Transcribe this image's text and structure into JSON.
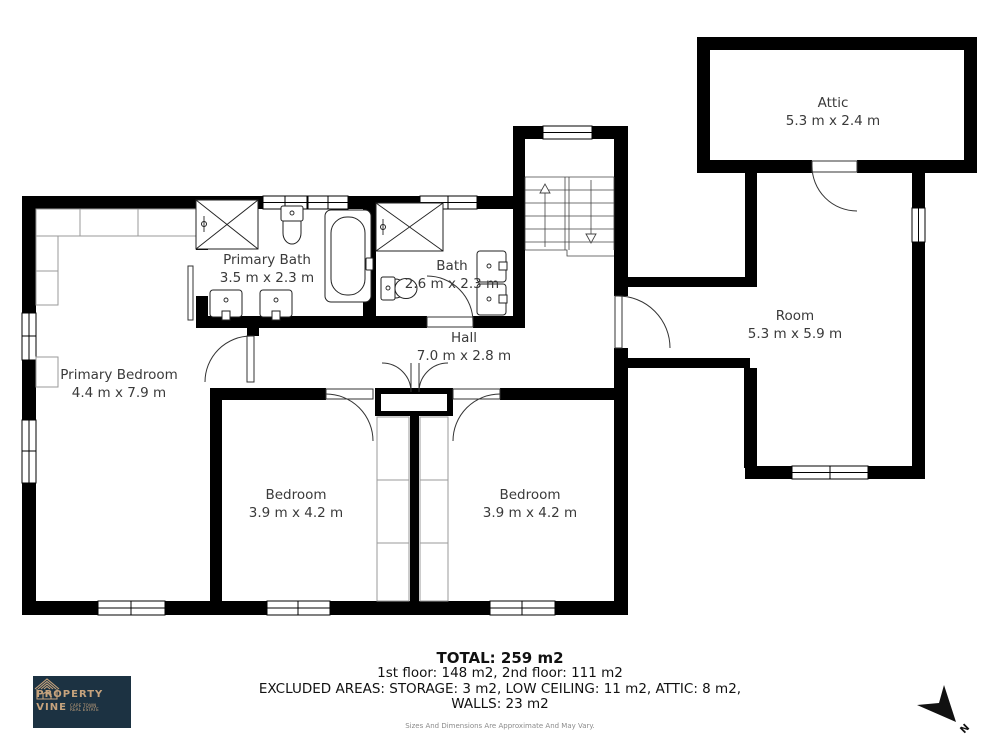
{
  "rooms": [
    {
      "name": "Attic",
      "dims": "5.3 m x 2.4 m"
    },
    {
      "name": "Room",
      "dims": "5.3 m x 5.9 m"
    },
    {
      "name": "Primary Bath",
      "dims": "3.5 m x 2.3 m"
    },
    {
      "name": "Bath",
      "dims": "2.6 m x 2.3 m"
    },
    {
      "name": "Hall",
      "dims": "7.0 m x 2.8 m"
    },
    {
      "name": "Primary Bedroom",
      "dims": "4.4 m x 7.9 m"
    },
    {
      "name": "Bedroom",
      "dims": "3.9 m x 4.2 m"
    },
    {
      "name": "Bedroom",
      "dims": "3.9 m x 4.2 m"
    }
  ],
  "summary": {
    "total": "TOTAL: 259 m2",
    "floors": "1st floor: 148 m2, 2nd floor: 111 m2",
    "excluded": "EXCLUDED AREAS: STORAGE: 3 m2, LOW CEILING: 11 m2, ATTIC: 8 m2,",
    "walls": "WALLS: 23 m2",
    "disclaimer": "Sizes And Dimensions Are Approximate And May Vary."
  },
  "logo": {
    "name_line1": "PROPERTY",
    "name_line2": "VINE",
    "tagline_line1": "CAPE TOWN",
    "tagline_line2": "REAL ESTATE",
    "bg_color": "#1c3242",
    "accent_color": "#c6a37d"
  },
  "compass": {
    "label": "N"
  },
  "colors": {
    "wall": "#000000",
    "label_text": "#3a3a3a",
    "closet_outline": "#9a9a9a"
  }
}
